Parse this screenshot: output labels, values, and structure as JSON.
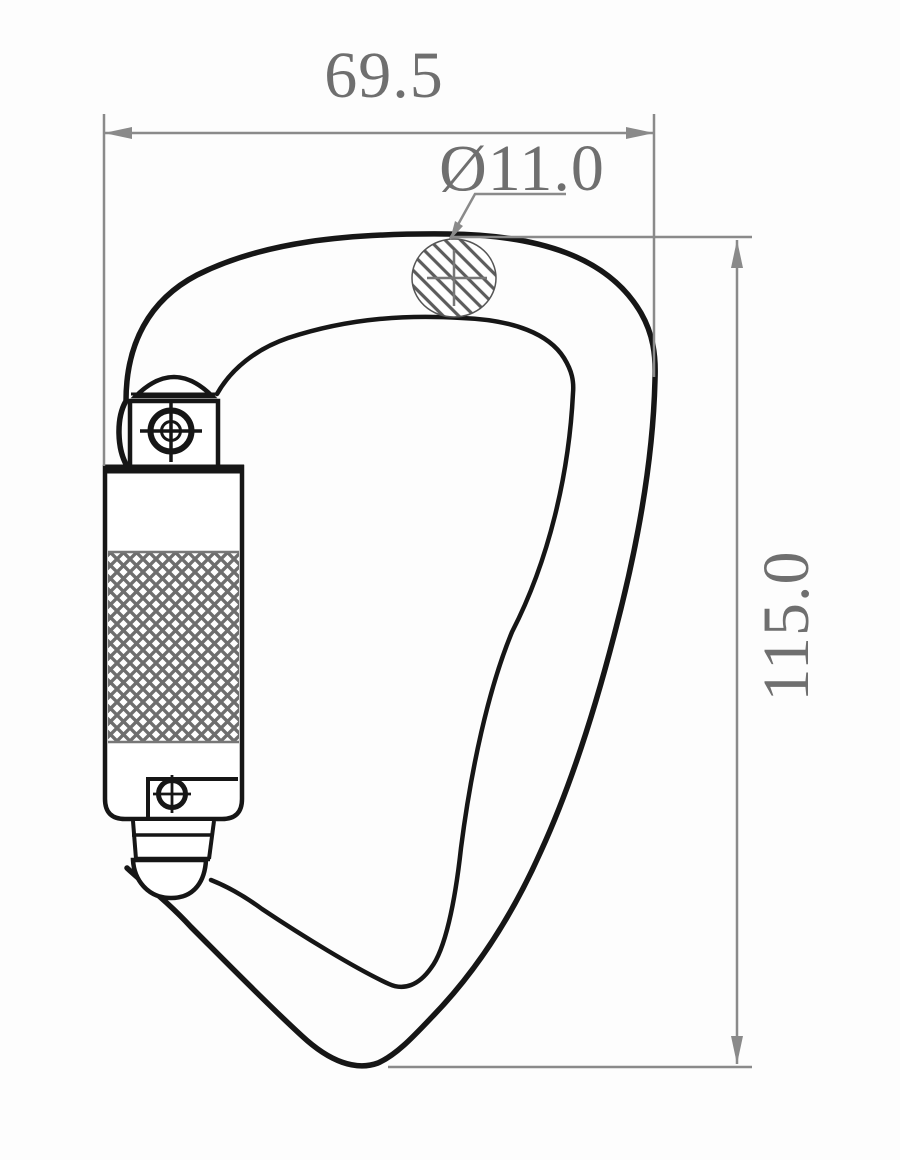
{
  "drawing": {
    "type": "technical-drawing",
    "subject": "screw-lock carabiner side view with dimensions",
    "labels": {
      "width": "69.5",
      "section_diameter": "Ø11.0",
      "height": "115.0"
    },
    "colors": {
      "outline": "#161616",
      "dimension_line": "#8a8a8a",
      "dimension_text": "#6f6f6f",
      "hatch": "#5c5c5c",
      "knurl": "#6e6e6e",
      "background": "#fdfdfd"
    }
  }
}
